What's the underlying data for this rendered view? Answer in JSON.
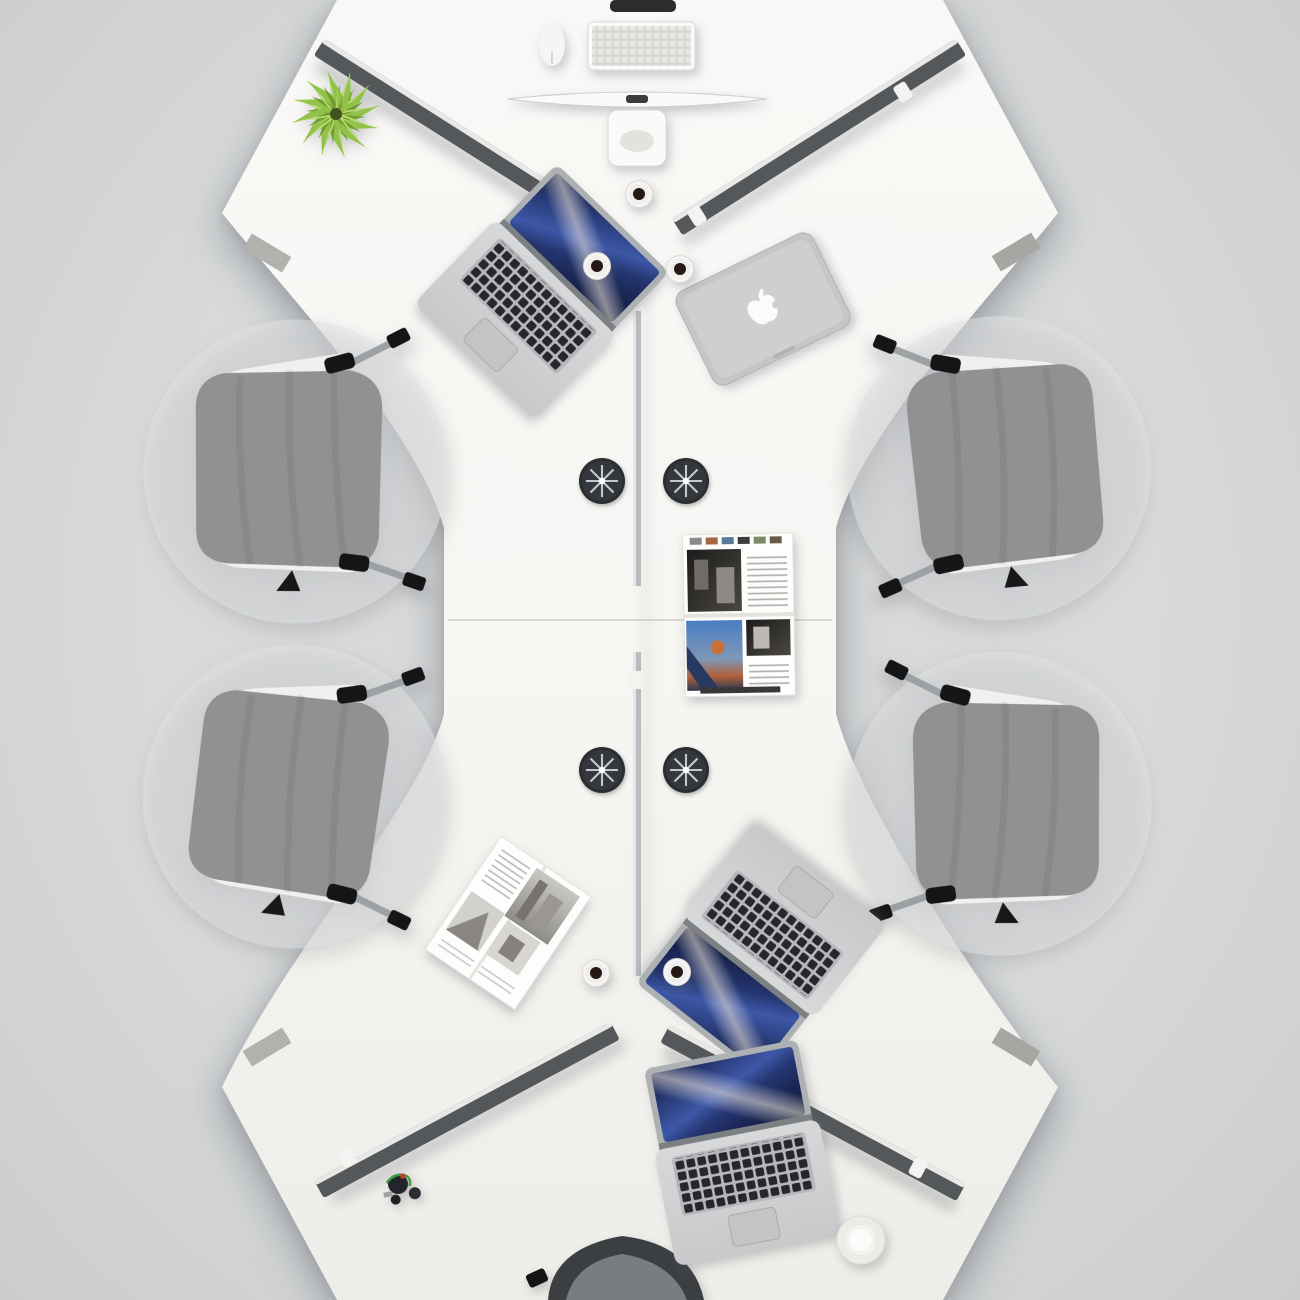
{
  "meta": {
    "type": "product-render",
    "subject": "Top view of a white 6-person 120-degree modular office workstation cluster with gray swivel chairs",
    "view": "bird's-eye"
  },
  "scene": {
    "workstation": {
      "label": "white 3-pod Y-shaped desk cluster x2, joined vertically",
      "seats": 6
    },
    "privacy_panels": [
      "top-left",
      "top-right",
      "center-spine-top",
      "center-spine-bottom",
      "bottom-left",
      "bottom-right"
    ],
    "chairs": {
      "full": 4,
      "partial": 2,
      "style": "gray fabric cushion, white loop frame, black armrests"
    },
    "devices": {
      "open_laptops": 3,
      "closed_macbook": 1,
      "desktop_monitor": 1,
      "white_keyboard": 1,
      "white_mouse": 1
    },
    "accessories": {
      "coffee_cups": 5,
      "cup_with_saucer": 1,
      "cable_grommets": 4,
      "open_magazines": 2,
      "green_plant": 1,
      "cable_bundle": 1
    }
  },
  "palette": {
    "bg": "#d7d9da",
    "bgEdge": "#cbcdce",
    "mat": "#e0e2e3",
    "desk": "#f7f6f3",
    "seam": "#dbd8d4",
    "panelDark": "#4f5255",
    "panelMid": "#73777a",
    "panelLight": "#aaaeb1",
    "panelEdge": "#e9e8e6",
    "spine": "#b9bcbe",
    "clip": "#f4f3f1",
    "leg": "#b3b1ad",
    "chairCushion": "#8f9193",
    "chairFrame": "#f1f0ee",
    "chairBlack": "#141517",
    "chairSilver": "#9da1a4",
    "partialChairDark": "#3c3f42",
    "partialChairSeat": "#7a7d80",
    "laptopSilver": "#c7c9cb",
    "laptopKeyDark": "#26272a",
    "keyboardBase": "#b5b7ba",
    "screenA": "#121a40",
    "screenB": "#3d58a8",
    "macbook": "#c4c6c8",
    "apple": "#fbfbfa",
    "monitorWhite": "#fafaf8",
    "keyWhite": "#e8e7e4",
    "kbBase": "#d7d5d2",
    "cup": "#f6f5f3",
    "coffee": "#241a13",
    "saucer": "#edebe8",
    "grommet": "#34373b",
    "grommetRim": "#2b2e31",
    "spoke": "#c6c9cb",
    "grommetDot": "#ffffff",
    "page": "#fdfdfc",
    "pageShade": "#e6e3df",
    "photoDarkA": "#1d1c1a",
    "photoDarkB": "#4a4743",
    "photoGrayA": "#c9c7c4",
    "photoGrayB": "#8e8c89",
    "photoBlue": "#4a7ec2",
    "photoOrange": "#b06038",
    "textLine": "#b4b2af",
    "plantA": "#6f9d2f",
    "plantB": "#93c24a",
    "plantC": "#b5d96a",
    "plantCore": "#41511f",
    "cable": "#23252a",
    "cableGreen": "#3f9f3f",
    "cableRed": "#c23b2e"
  }
}
